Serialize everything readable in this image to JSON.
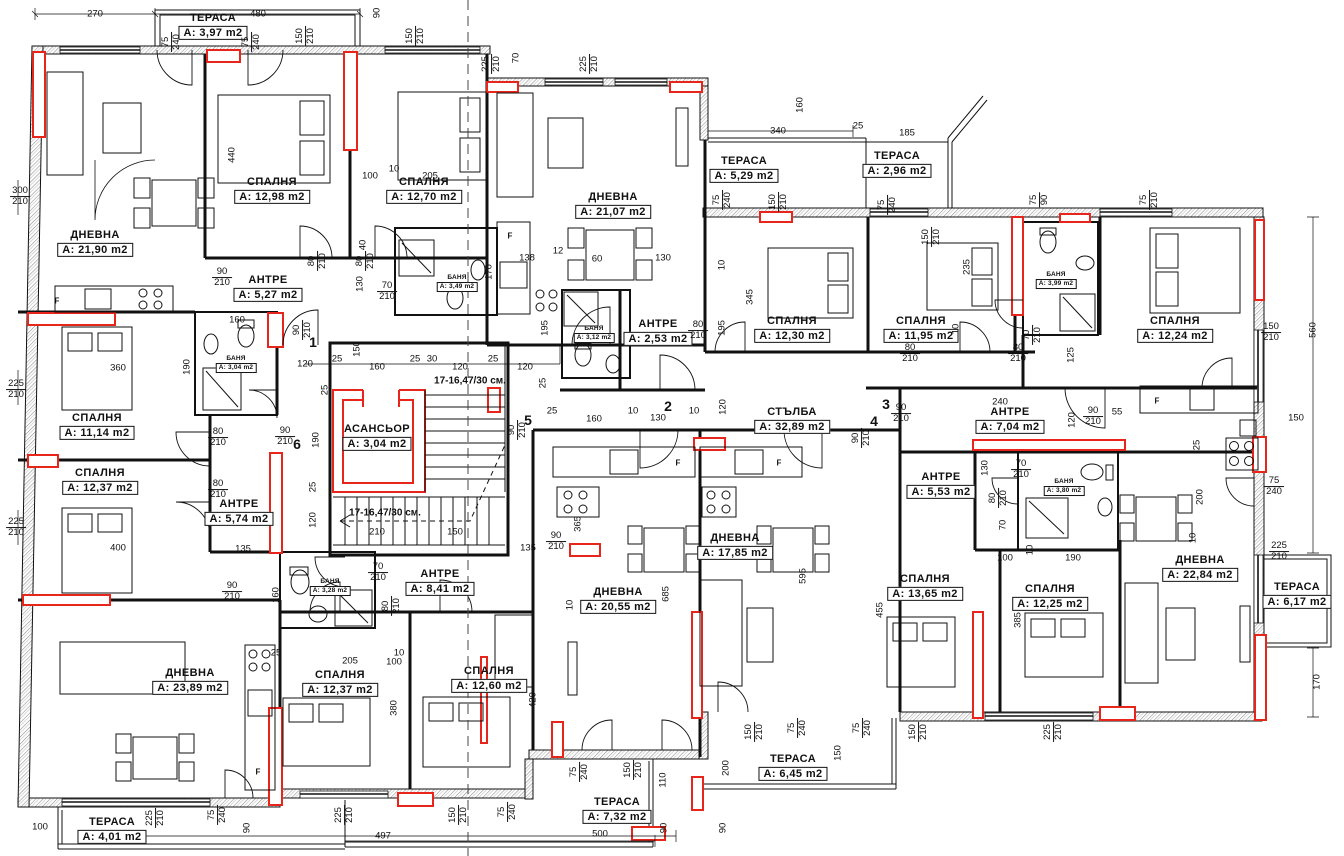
{
  "plan": {
    "drawing_type": "apartment-building-floor-plan",
    "language": "bg",
    "colors": {
      "wall": "#111111",
      "accent_red": "#e8251b",
      "background": "#ffffff",
      "hatch": "#909090"
    },
    "rooms": [
      {
        "name": "ТЕРАСА",
        "area": "A: 3,97 m2",
        "x": 213,
        "y": 26
      },
      {
        "name": "СПАЛНЯ",
        "area": "A: 12,98 m2",
        "x": 272,
        "y": 190
      },
      {
        "name": "СПАЛНЯ",
        "area": "A: 12,70 m2",
        "x": 424,
        "y": 190
      },
      {
        "name": "ДНЕВНА",
        "area": "A: 21,90 m2",
        "x": 95,
        "y": 243
      },
      {
        "name": "АНТРЕ",
        "area": "A: 5,27 m2",
        "x": 268,
        "y": 288
      },
      {
        "name": "БАНЯ",
        "area": "A: 3,49 m2",
        "x": 457,
        "y": 283,
        "sm": 1
      },
      {
        "name": "ДНЕВНА",
        "area": "A: 21,07 m2",
        "x": 613,
        "y": 205
      },
      {
        "name": "ТЕРАСА",
        "area": "A: 5,29 m2",
        "x": 744,
        "y": 169
      },
      {
        "name": "ТЕРАСА",
        "area": "A: 2,96 m2",
        "x": 897,
        "y": 164
      },
      {
        "name": "БАНЯ",
        "area": "A: 3,04 m2",
        "x": 236,
        "y": 364,
        "sm": 1
      },
      {
        "name": "СПАЛНЯ",
        "area": "A: 11,14 m2",
        "x": 97,
        "y": 426
      },
      {
        "name": "СПАЛНЯ",
        "area": "A: 12,37 m2",
        "x": 100,
        "y": 481
      },
      {
        "name": "АНТРЕ",
        "area": "A: 5,74 m2",
        "x": 239,
        "y": 512
      },
      {
        "name": "АСАНСЬОР",
        "area": "A: 3,04 m2",
        "x": 377,
        "y": 437
      },
      {
        "name": "БАНЯ",
        "area": "A: 3,12 m2",
        "x": 594,
        "y": 334,
        "sm": 1
      },
      {
        "name": "АНТРЕ",
        "area": "A: 2,53 m2",
        "x": 658,
        "y": 332
      },
      {
        "name": "СПАЛНЯ",
        "area": "A: 12,30 m2",
        "x": 792,
        "y": 329
      },
      {
        "name": "СПАЛНЯ",
        "area": "A: 11,95 m2",
        "x": 921,
        "y": 329
      },
      {
        "name": "БАНЯ",
        "area": "A: 3,99 m2",
        "x": 1056,
        "y": 280,
        "sm": 1
      },
      {
        "name": "СПАЛНЯ",
        "area": "A: 12,24 m2",
        "x": 1175,
        "y": 329
      },
      {
        "name": "СТЪЛБА",
        "area": "A: 32,89 m2",
        "x": 792,
        "y": 420
      },
      {
        "name": "АНТРЕ",
        "area": "A: 7,04 m2",
        "x": 1010,
        "y": 420
      },
      {
        "name": "АНТРЕ",
        "area": "A: 5,53 m2",
        "x": 941,
        "y": 485
      },
      {
        "name": "БАНЯ",
        "area": "A: 3,80 m2",
        "x": 1064,
        "y": 487,
        "sm": 1
      },
      {
        "name": "БАНЯ",
        "area": "A: 3,28 m2",
        "x": 330,
        "y": 587,
        "sm": 1
      },
      {
        "name": "АНТРЕ",
        "area": "A: 8,41 m2",
        "x": 440,
        "y": 582
      },
      {
        "name": "ДНЕВНА",
        "area": "A: 17,85 m2",
        "x": 735,
        "y": 546
      },
      {
        "name": "ДНЕВНА",
        "area": "A: 20,55 m2",
        "x": 618,
        "y": 600
      },
      {
        "name": "СПАЛНЯ",
        "area": "A: 13,65 m2",
        "x": 925,
        "y": 587
      },
      {
        "name": "СПАЛНЯ",
        "area": "A: 12,25 m2",
        "x": 1050,
        "y": 597
      },
      {
        "name": "ДНЕВНА",
        "area": "A: 22,84 m2",
        "x": 1200,
        "y": 568
      },
      {
        "name": "ТЕРАСА",
        "area": "A: 6,17 m2",
        "x": 1297,
        "y": 595
      },
      {
        "name": "ДНЕВНА",
        "area": "A: 23,89 m2",
        "x": 190,
        "y": 681
      },
      {
        "name": "СПАЛНЯ",
        "area": "A: 12,37 m2",
        "x": 340,
        "y": 683
      },
      {
        "name": "СПАЛНЯ",
        "area": "A: 12,60 m2",
        "x": 489,
        "y": 679
      },
      {
        "name": "ТЕРАСА",
        "area": "A: 4,01 m2",
        "x": 112,
        "y": 830
      },
      {
        "name": "ТЕРАСА",
        "area": "A: 7,32 m2",
        "x": 617,
        "y": 810
      },
      {
        "name": "ТЕРАСА",
        "area": "A: 6,45 m2",
        "x": 793,
        "y": 767
      }
    ],
    "unit_numbers": [
      {
        "n": "1",
        "x": 313,
        "y": 342
      },
      {
        "n": "2",
        "x": 668,
        "y": 406
      },
      {
        "n": "3",
        "x": 886,
        "y": 404
      },
      {
        "n": "4",
        "x": 874,
        "y": 421
      },
      {
        "n": "5",
        "x": 528,
        "y": 420
      },
      {
        "n": "6",
        "x": 297,
        "y": 444
      }
    ],
    "notes": [
      {
        "t": "17-16,47/30 см.",
        "x": 470,
        "y": 381
      },
      {
        "t": "17-16,47/30 см.",
        "x": 385,
        "y": 513
      }
    ],
    "fridge_letters": [
      {
        "t": "F",
        "x": 57,
        "y": 301
      },
      {
        "t": "F",
        "x": 510,
        "y": 236
      },
      {
        "t": "F",
        "x": 678,
        "y": 463
      },
      {
        "t": "F",
        "x": 779,
        "y": 463
      },
      {
        "t": "F",
        "x": 1157,
        "y": 401
      },
      {
        "t": "F",
        "x": 258,
        "y": 772
      }
    ],
    "dimensions": [
      {
        "t": "270",
        "x": 95,
        "y": 14
      },
      {
        "t": "480",
        "x": 258,
        "y": 14
      },
      {
        "t": "90",
        "x": 377,
        "y": 13,
        "r": 1
      },
      {
        "t": "75/240",
        "x": 172,
        "y": 42,
        "r": 1,
        "f": 1
      },
      {
        "t": "75/240",
        "x": 252,
        "y": 42,
        "r": 1,
        "f": 1
      },
      {
        "t": "150/210",
        "x": 306,
        "y": 36,
        "r": 1,
        "f": 1
      },
      {
        "t": "150/210",
        "x": 416,
        "y": 36,
        "r": 1,
        "f": 1
      },
      {
        "t": "225/210",
        "x": 492,
        "y": 64,
        "r": 1,
        "f": 1
      },
      {
        "t": "70",
        "x": 516,
        "y": 58,
        "r": 1
      },
      {
        "t": "225/210",
        "x": 590,
        "y": 64,
        "r": 1,
        "f": 1
      },
      {
        "t": "160",
        "x": 800,
        "y": 105,
        "r": 1
      },
      {
        "t": "340",
        "x": 778,
        "y": 131
      },
      {
        "t": "25",
        "x": 858,
        "y": 126
      },
      {
        "t": "185",
        "x": 907,
        "y": 133
      },
      {
        "t": "75/240",
        "x": 723,
        "y": 200,
        "r": 1,
        "f": 1
      },
      {
        "t": "150/210",
        "x": 779,
        "y": 202,
        "r": 1,
        "f": 1
      },
      {
        "t": "75/240",
        "x": 888,
        "y": 205,
        "r": 1,
        "f": 1
      },
      {
        "t": "75/90",
        "x": 1040,
        "y": 200,
        "r": 1,
        "f": 1
      },
      {
        "t": "75/210",
        "x": 1150,
        "y": 200,
        "r": 1,
        "f": 1
      },
      {
        "t": "150/210",
        "x": 932,
        "y": 237,
        "r": 1,
        "f": 1
      },
      {
        "t": "235",
        "x": 967,
        "y": 267,
        "r": 1
      },
      {
        "t": "345",
        "x": 750,
        "y": 297,
        "r": 1
      },
      {
        "t": "195",
        "x": 722,
        "y": 328,
        "r": 1
      },
      {
        "t": "10",
        "x": 722,
        "y": 265,
        "r": 1
      },
      {
        "t": "130",
        "x": 663,
        "y": 258
      },
      {
        "t": "120",
        "x": 723,
        "y": 407,
        "r": 1
      },
      {
        "t": "80/210",
        "x": 698,
        "y": 331,
        "f": 1
      },
      {
        "t": "10",
        "x": 956,
        "y": 329,
        "r": 1
      },
      {
        "t": "80/210",
        "x": 910,
        "y": 354,
        "f": 1
      },
      {
        "t": "80/210",
        "x": 1018,
        "y": 354,
        "f": 1
      },
      {
        "t": "70/210",
        "x": 1033,
        "y": 335,
        "r": 1,
        "f": 1
      },
      {
        "t": "125",
        "x": 1071,
        "y": 355,
        "r": 1
      },
      {
        "t": "150/210",
        "x": 1271,
        "y": 333,
        "f": 1
      },
      {
        "t": "560",
        "x": 1313,
        "y": 330,
        "r": 1
      },
      {
        "t": "150",
        "x": 1296,
        "y": 418
      },
      {
        "t": "75/240",
        "x": 1274,
        "y": 487,
        "f": 1
      },
      {
        "t": "225/210",
        "x": 1279,
        "y": 552,
        "f": 1
      },
      {
        "t": "170",
        "x": 1317,
        "y": 682,
        "r": 1
      },
      {
        "t": "300/210",
        "x": 20,
        "y": 197,
        "f": 1
      },
      {
        "t": "440",
        "x": 232,
        "y": 155,
        "r": 1
      },
      {
        "t": "100",
        "x": 370,
        "y": 176
      },
      {
        "t": "10",
        "x": 394,
        "y": 169
      },
      {
        "t": "205",
        "x": 430,
        "y": 176
      },
      {
        "t": "90/210",
        "x": 222,
        "y": 278,
        "f": 1
      },
      {
        "t": "80/210",
        "x": 318,
        "y": 261,
        "r": 1,
        "f": 1
      },
      {
        "t": "80/210",
        "x": 366,
        "y": 261,
        "r": 1,
        "f": 1
      },
      {
        "t": "130",
        "x": 360,
        "y": 284,
        "r": 1
      },
      {
        "t": "40",
        "x": 363,
        "y": 245,
        "r": 1
      },
      {
        "t": "70/210",
        "x": 387,
        "y": 292,
        "f": 1
      },
      {
        "t": "160",
        "x": 237,
        "y": 320
      },
      {
        "t": "360",
        "x": 118,
        "y": 368
      },
      {
        "t": "190",
        "x": 187,
        "y": 367,
        "r": 1
      },
      {
        "t": "225/210",
        "x": 16,
        "y": 390,
        "f": 1
      },
      {
        "t": "225/210",
        "x": 16,
        "y": 528,
        "f": 1
      },
      {
        "t": "90/210",
        "x": 303,
        "y": 330,
        "r": 1,
        "f": 1
      },
      {
        "t": "80/210",
        "x": 218,
        "y": 438,
        "f": 1
      },
      {
        "t": "80/210",
        "x": 218,
        "y": 490,
        "f": 1
      },
      {
        "t": "90/210",
        "x": 285,
        "y": 437,
        "f": 1
      },
      {
        "t": "120",
        "x": 305,
        "y": 364
      },
      {
        "t": "25",
        "x": 337,
        "y": 359
      },
      {
        "t": "160",
        "x": 377,
        "y": 367
      },
      {
        "t": "25",
        "x": 415,
        "y": 359
      },
      {
        "t": "30",
        "x": 432,
        "y": 359
      },
      {
        "t": "120",
        "x": 460,
        "y": 367
      },
      {
        "t": "25",
        "x": 493,
        "y": 359
      },
      {
        "t": "120",
        "x": 525,
        "y": 367
      },
      {
        "t": "150",
        "x": 357,
        "y": 349,
        "r": 1
      },
      {
        "t": "25",
        "x": 325,
        "y": 390,
        "r": 1
      },
      {
        "t": "190",
        "x": 316,
        "y": 440,
        "r": 1
      },
      {
        "t": "25",
        "x": 313,
        "y": 487,
        "r": 1
      },
      {
        "t": "120",
        "x": 313,
        "y": 520,
        "r": 1
      },
      {
        "t": "210",
        "x": 377,
        "y": 532
      },
      {
        "t": "150",
        "x": 455,
        "y": 532
      },
      {
        "t": "135",
        "x": 528,
        "y": 548
      },
      {
        "t": "90/210",
        "x": 556,
        "y": 542,
        "f": 1
      },
      {
        "t": "135",
        "x": 243,
        "y": 549
      },
      {
        "t": "400",
        "x": 118,
        "y": 548
      },
      {
        "t": "90/210",
        "x": 232,
        "y": 592,
        "f": 1
      },
      {
        "t": "160",
        "x": 276,
        "y": 595,
        "r": 1
      },
      {
        "t": "70/210",
        "x": 378,
        "y": 573,
        "f": 1
      },
      {
        "t": "80/210",
        "x": 392,
        "y": 606,
        "r": 1,
        "f": 1
      },
      {
        "t": "90/210",
        "x": 518,
        "y": 430,
        "r": 1,
        "f": 1
      },
      {
        "t": "25",
        "x": 552,
        "y": 411
      },
      {
        "t": "160",
        "x": 594,
        "y": 419
      },
      {
        "t": "138",
        "x": 527,
        "y": 258
      },
      {
        "t": "12",
        "x": 558,
        "y": 251
      },
      {
        "t": "60",
        "x": 597,
        "y": 259
      },
      {
        "t": "170",
        "x": 489,
        "y": 272,
        "r": 1
      },
      {
        "t": "195",
        "x": 545,
        "y": 328,
        "r": 1
      },
      {
        "t": "25",
        "x": 543,
        "y": 383,
        "r": 1
      },
      {
        "t": "10",
        "x": 633,
        "y": 411
      },
      {
        "t": "130",
        "x": 658,
        "y": 418
      },
      {
        "t": "10",
        "x": 694,
        "y": 411
      },
      {
        "t": "90/210",
        "x": 901,
        "y": 414,
        "f": 1
      },
      {
        "t": "240",
        "x": 1000,
        "y": 402
      },
      {
        "t": "90/210",
        "x": 862,
        "y": 438,
        "r": 1,
        "f": 1
      },
      {
        "t": "90/210",
        "x": 1093,
        "y": 417,
        "f": 1
      },
      {
        "t": "55",
        "x": 1117,
        "y": 412
      },
      {
        "t": "120",
        "x": 1072,
        "y": 420,
        "r": 1
      },
      {
        "t": "130",
        "x": 985,
        "y": 468,
        "r": 1
      },
      {
        "t": "70/210",
        "x": 1021,
        "y": 470,
        "f": 1
      },
      {
        "t": "80/210",
        "x": 999,
        "y": 498,
        "r": 1,
        "f": 1
      },
      {
        "t": "70",
        "x": 1003,
        "y": 525,
        "r": 1
      },
      {
        "t": "100",
        "x": 1005,
        "y": 558
      },
      {
        "t": "10",
        "x": 1030,
        "y": 550,
        "r": 1
      },
      {
        "t": "190",
        "x": 1073,
        "y": 558
      },
      {
        "t": "385",
        "x": 1018,
        "y": 620,
        "r": 1
      },
      {
        "t": "25",
        "x": 1197,
        "y": 445,
        "r": 1
      },
      {
        "t": "200",
        "x": 1200,
        "y": 497,
        "r": 1
      },
      {
        "t": "10",
        "x": 1193,
        "y": 538,
        "r": 1
      },
      {
        "t": "455",
        "x": 880,
        "y": 610,
        "r": 1
      },
      {
        "t": "365",
        "x": 578,
        "y": 524,
        "r": 1
      },
      {
        "t": "685",
        "x": 666,
        "y": 594,
        "r": 1
      },
      {
        "t": "595",
        "x": 803,
        "y": 576,
        "r": 1
      },
      {
        "t": "10",
        "x": 570,
        "y": 605,
        "r": 1
      },
      {
        "t": "420",
        "x": 533,
        "y": 700,
        "r": 1
      },
      {
        "t": "380",
        "x": 394,
        "y": 708,
        "r": 1
      },
      {
        "t": "100",
        "x": 394,
        "y": 662
      },
      {
        "t": "205",
        "x": 350,
        "y": 661
      },
      {
        "t": "10",
        "x": 399,
        "y": 653
      },
      {
        "t": "25",
        "x": 276,
        "y": 653
      },
      {
        "t": "100",
        "x": 40,
        "y": 827
      },
      {
        "t": "225/210",
        "x": 156,
        "y": 818,
        "r": 1,
        "f": 1
      },
      {
        "t": "75/240",
        "x": 218,
        "y": 815,
        "r": 1,
        "f": 1
      },
      {
        "t": "90",
        "x": 247,
        "y": 828,
        "r": 1
      },
      {
        "t": "497",
        "x": 383,
        "y": 836
      },
      {
        "t": "225/210",
        "x": 345,
        "y": 815,
        "r": 1,
        "f": 1
      },
      {
        "t": "150/210",
        "x": 459,
        "y": 815,
        "r": 1,
        "f": 1
      },
      {
        "t": "75/240",
        "x": 508,
        "y": 812,
        "r": 1,
        "f": 1
      },
      {
        "t": "75/240",
        "x": 580,
        "y": 772,
        "r": 1,
        "f": 1
      },
      {
        "t": "150/210",
        "x": 634,
        "y": 770,
        "r": 1,
        "f": 1
      },
      {
        "t": "110",
        "x": 663,
        "y": 780,
        "r": 1
      },
      {
        "t": "90",
        "x": 664,
        "y": 828,
        "r": 1
      },
      {
        "t": "500",
        "x": 600,
        "y": 834
      },
      {
        "t": "90",
        "x": 723,
        "y": 828,
        "r": 1
      },
      {
        "t": "200",
        "x": 726,
        "y": 768,
        "r": 1
      },
      {
        "t": "150/210",
        "x": 755,
        "y": 732,
        "r": 1,
        "f": 1
      },
      {
        "t": "75/240",
        "x": 798,
        "y": 728,
        "r": 1,
        "f": 1
      },
      {
        "t": "150",
        "x": 838,
        "y": 753,
        "r": 1
      },
      {
        "t": "75/240",
        "x": 863,
        "y": 728,
        "r": 1,
        "f": 1
      },
      {
        "t": "150/210",
        "x": 919,
        "y": 732,
        "r": 1,
        "f": 1
      },
      {
        "t": "225/210",
        "x": 1054,
        "y": 732,
        "r": 1,
        "f": 1
      }
    ]
  }
}
